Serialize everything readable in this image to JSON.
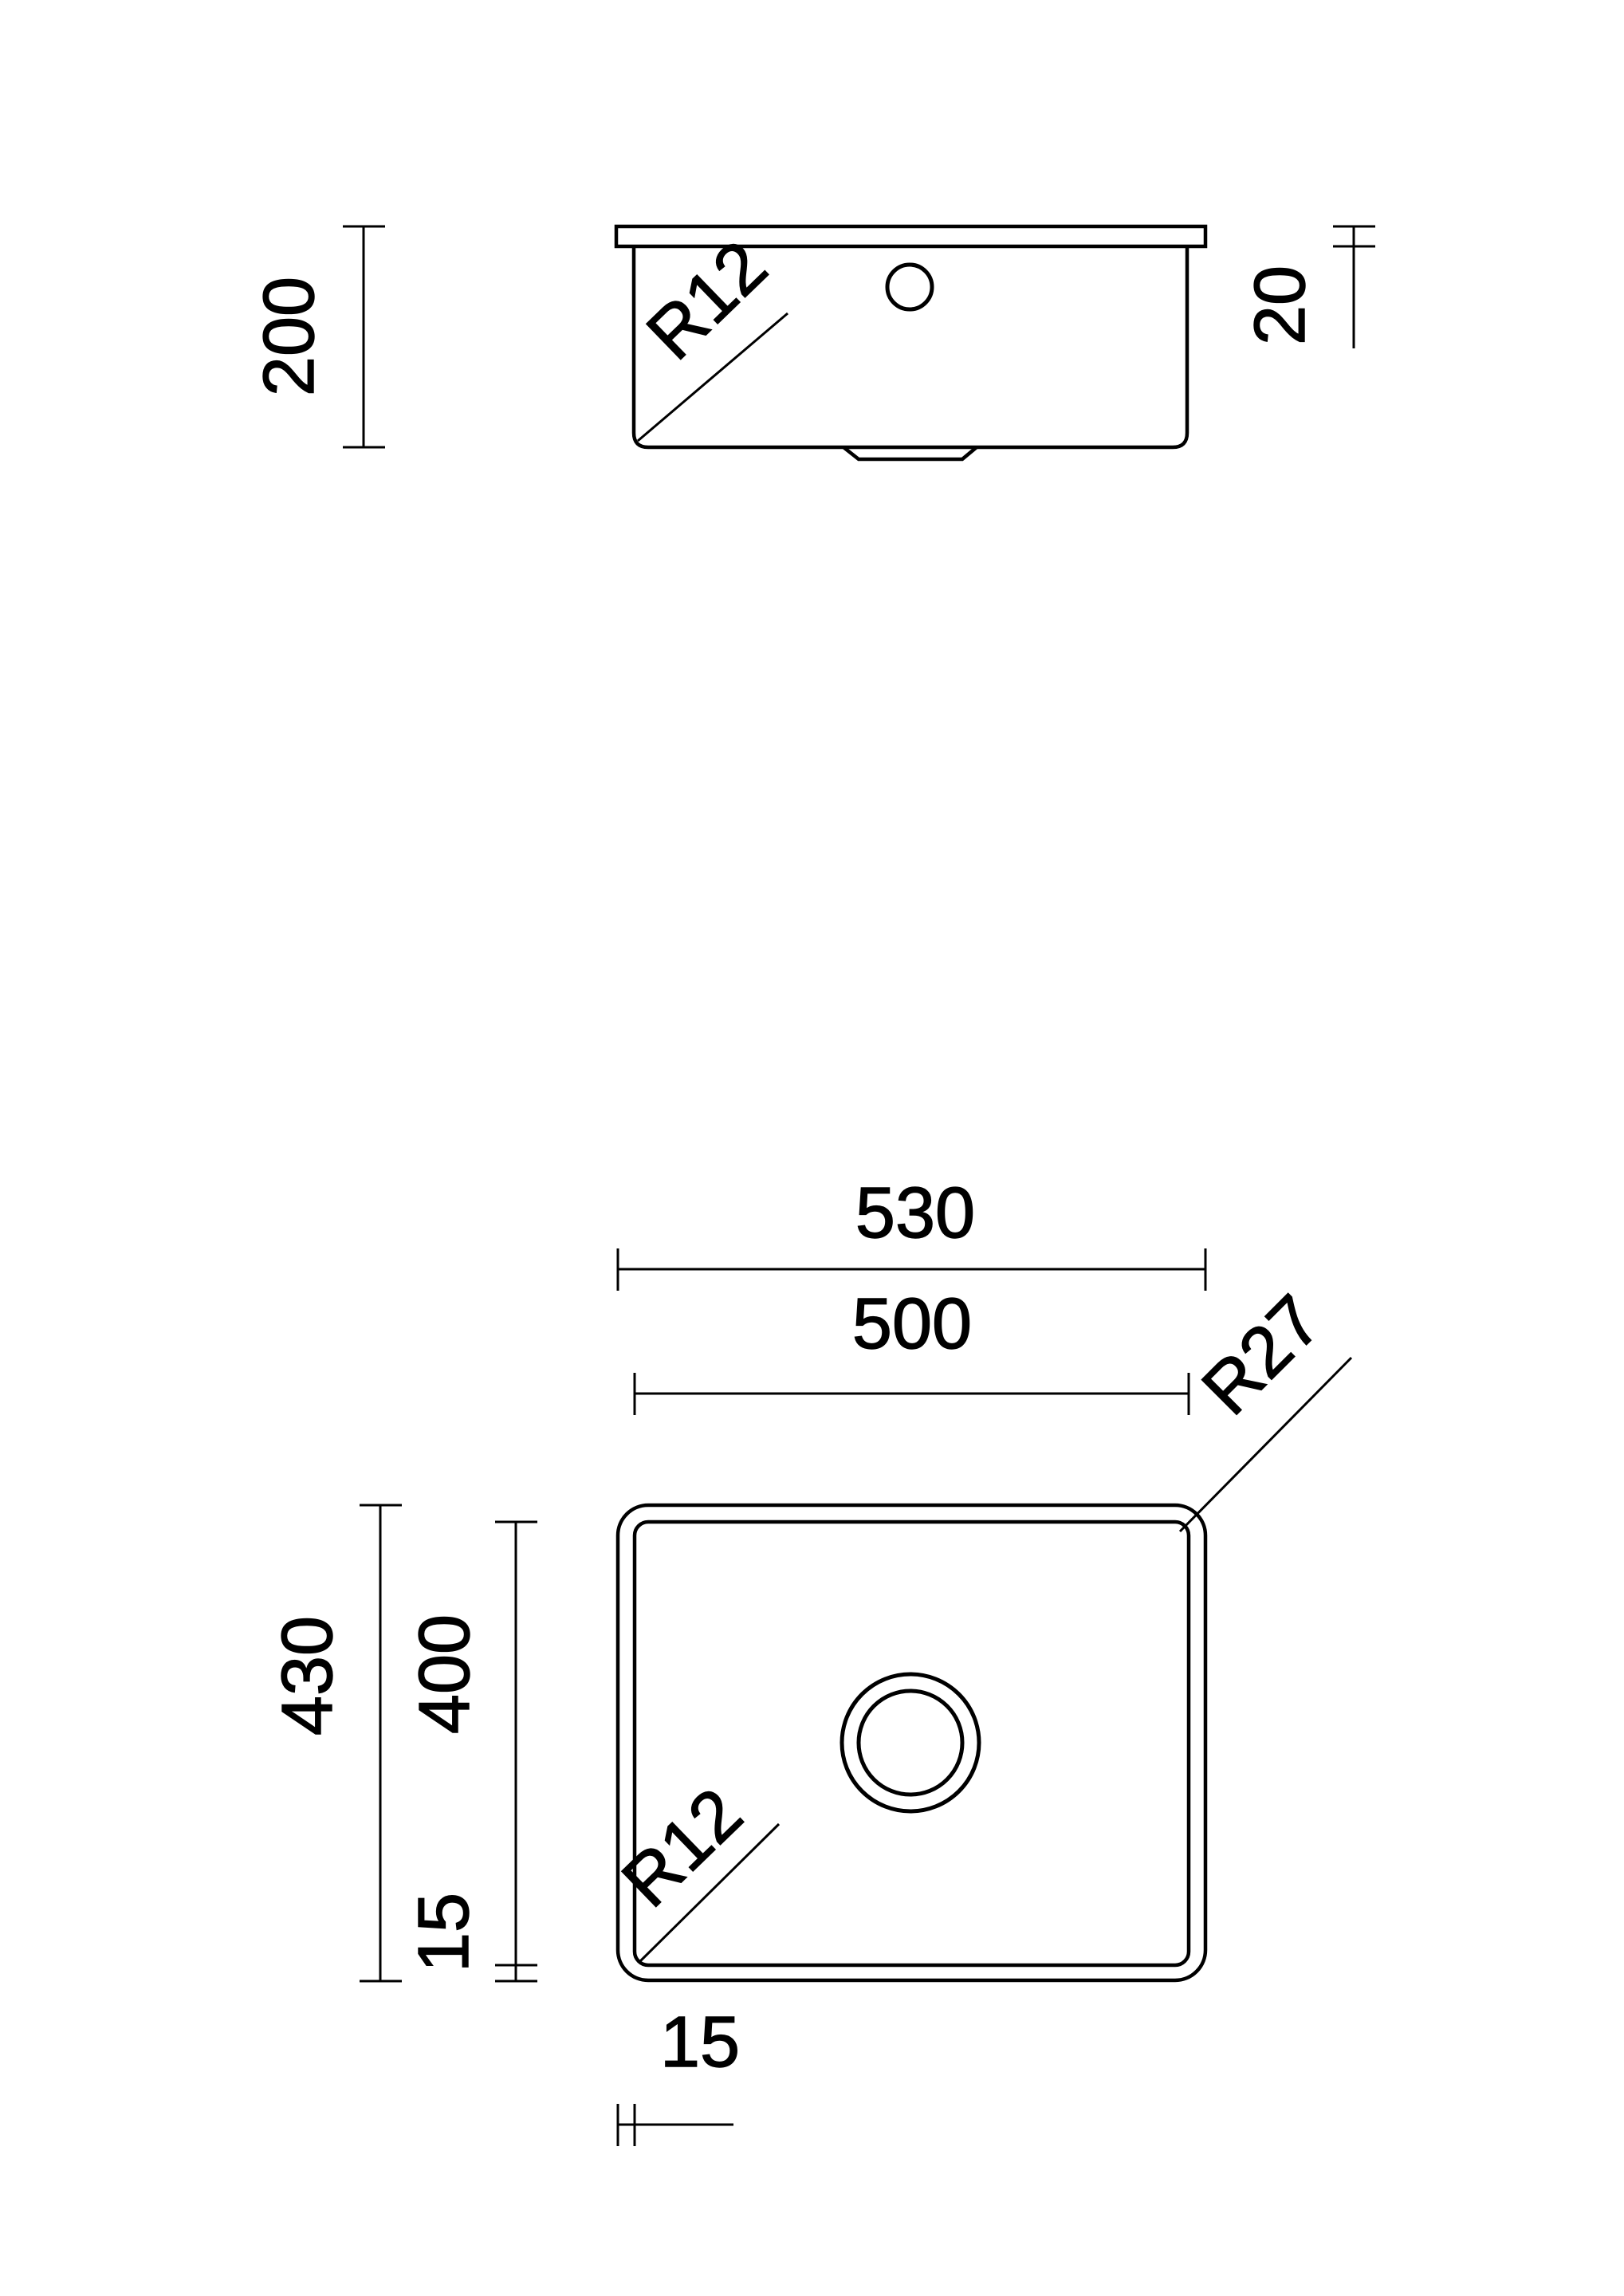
{
  "document": {
    "type": "technical-drawing",
    "subject": "undermount kitchen sink bowl",
    "background_color": "#ffffff",
    "line_color": "#000000"
  },
  "side_view": {
    "name": "side section view",
    "labels": {
      "bowl_depth": "200",
      "rim_thickness": "20",
      "bottom_corner_radius": "R12"
    }
  },
  "plan_view": {
    "name": "top plan view",
    "labels": {
      "outer_width": "530",
      "inner_width": "500",
      "outer_depth": "430",
      "inner_depth": "400",
      "rim_offset_left": "15",
      "rim_offset_bottom": "15",
      "outer_corner_radius": "R27",
      "inner_corner_radius": "R12"
    }
  }
}
